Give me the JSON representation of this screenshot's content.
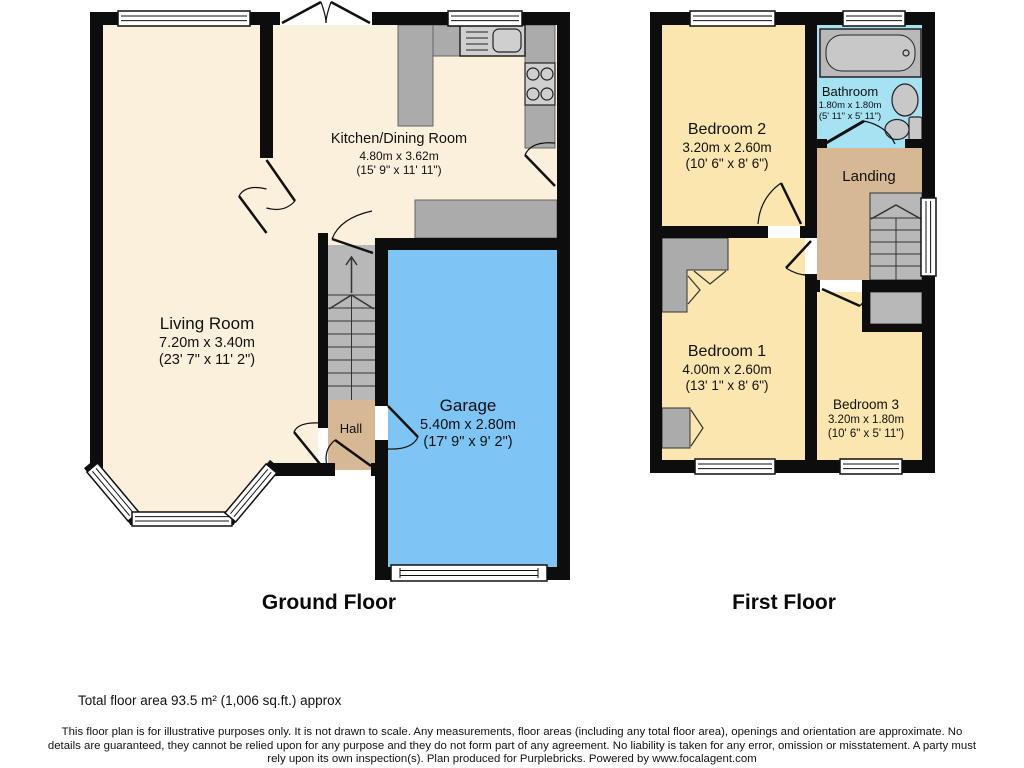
{
  "ground_floor": {
    "title": "Ground Floor",
    "rooms": {
      "living_room": {
        "name": "Living Room",
        "metric": "7.20m x 3.40m",
        "imperial": "(23' 7\" x 11' 2\")"
      },
      "kitchen_dining": {
        "name": "Kitchen/Dining Room",
        "metric": "4.80m x 3.62m",
        "imperial": "(15' 9\" x 11' 11\")"
      },
      "garage": {
        "name": "Garage",
        "metric": "5.40m x 2.80m",
        "imperial": "(17' 9\" x 9' 2\")"
      },
      "hall": {
        "name": "Hall"
      }
    }
  },
  "first_floor": {
    "title": "First Floor",
    "rooms": {
      "bedroom_2": {
        "name": "Bedroom 2",
        "metric": "3.20m x 2.60m",
        "imperial": "(10' 6\" x 8' 6\")"
      },
      "bathroom": {
        "name": "Bathroom",
        "metric": "1.80m x 1.80m",
        "imperial": "(5' 11\" x 5' 11\")"
      },
      "landing": {
        "name": "Landing"
      },
      "bedroom_1": {
        "name": "Bedroom 1",
        "metric": "4.00m x 2.60m",
        "imperial": "(13' 1\" x 8' 6\")"
      },
      "bedroom_3": {
        "name": "Bedroom 3",
        "metric": "3.20m x 1.80m",
        "imperial": "(10' 6\" x 5' 11\")"
      }
    }
  },
  "footer": {
    "total_area": "Total floor area 93.5 m² (1,006 sq.ft.) approx",
    "disclaimer": "This floor plan is for illustrative purposes only. It is not drawn to scale. Any measurements, floor areas (including any total floor area), openings and orientation are approximate. No details are guaranteed, they cannot be relied upon for any purpose and they do not form part of any agreement. No liability is taken for any error, omission or misstatement. A party must rely upon its own inspection(s). Plan produced for Purplebricks. Powered by www.focalagent.com"
  },
  "colors": {
    "wall": "#0d0d0d",
    "cream_floor": "#FBF0DC",
    "bedroom_floor": "#FAE6AE",
    "garage_floor": "#7EC4F5",
    "bathroom_floor": "#A5E2F2",
    "hall_floor": "#D7B894",
    "fixture_gray": "#ABABAB"
  }
}
